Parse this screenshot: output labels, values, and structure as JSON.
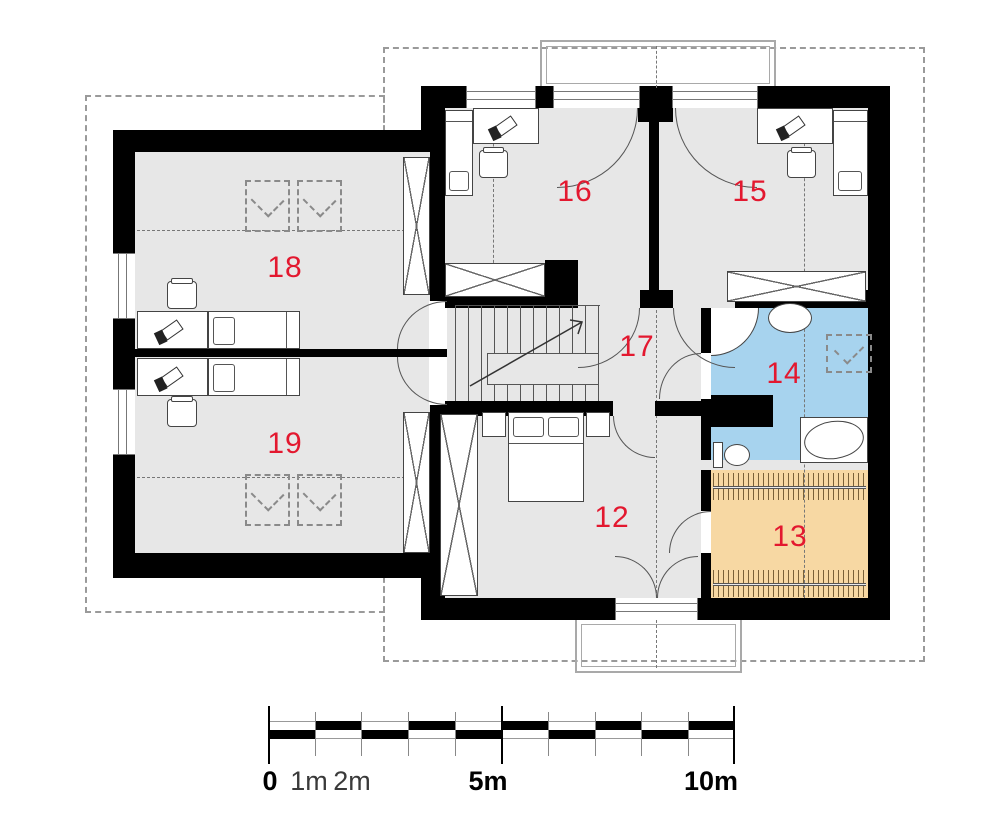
{
  "plan": {
    "type": "floor-plan",
    "rooms": [
      {
        "label": "12",
        "floor": "gray"
      },
      {
        "label": "13",
        "floor": "orange"
      },
      {
        "label": "14",
        "floor": "blue"
      },
      {
        "label": "15",
        "floor": "gray"
      },
      {
        "label": "16",
        "floor": "gray"
      },
      {
        "label": "17",
        "floor": "gray"
      },
      {
        "label": "18",
        "floor": "gray"
      },
      {
        "label": "19",
        "floor": "gray"
      }
    ]
  },
  "scalebar": {
    "labels": [
      "0",
      "1m",
      "2m",
      "5m",
      "10m"
    ],
    "total_meters": 10,
    "minor_tick_meters": 1,
    "major_ticks": [
      "0",
      "5m",
      "10m"
    ]
  },
  "colors": {
    "label_red": "#e3182f",
    "bath_blue": "#a7d3ee",
    "closet_orange": "#f7d8a3",
    "floor_gray": "#e7e7e7",
    "wall_black": "#000000",
    "outline_gray": "#9a9a9a"
  }
}
